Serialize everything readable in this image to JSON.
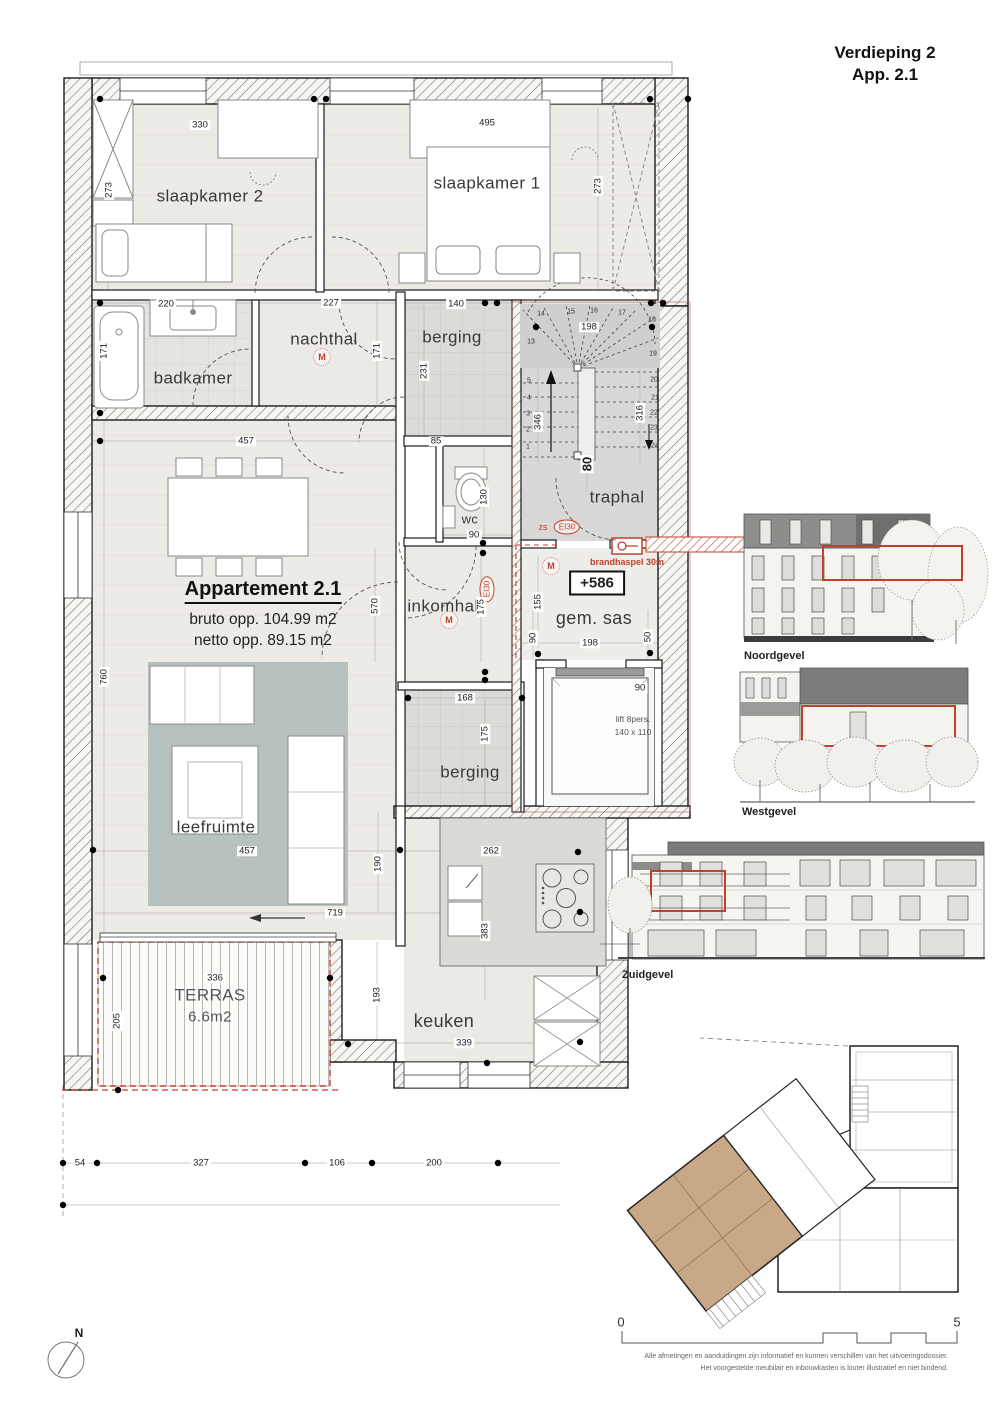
{
  "title": {
    "line1": "Verdieping 2",
    "line2": "App. 2.1"
  },
  "apartment": {
    "name": "Appartement 2.1",
    "bruto": "bruto opp. 104.99 m2",
    "netto": "netto opp. 89.15 m2"
  },
  "rooms": {
    "slaapkamer2": "slaapkamer 2",
    "slaapkamer1": "slaapkamer 1",
    "badkamer": "badkamer",
    "nachthal": "nachthal",
    "berging_top": "berging",
    "traphal": "traphal",
    "wc": "wc",
    "inkomhal": "inkomhal",
    "gem_sas": "gem. sas",
    "berging_bottom": "berging",
    "leefruimte": "leefruimte",
    "keuken": "keuken",
    "terras": "TERRAS",
    "terras_area": "6.6m2"
  },
  "annotations": {
    "level": "+586",
    "brandhaspel": "brandhaspel 30m",
    "zs": "zs",
    "ei30": "EI30",
    "lift_line1": "lift 8pers.",
    "lift_line2": "140 x 110",
    "m": "M"
  },
  "dims": [
    "330",
    "495",
    "273",
    "273",
    "220",
    "227",
    "140",
    "171",
    "171",
    "198",
    "231",
    "85",
    "346",
    "316",
    "80",
    "130",
    "90",
    "457",
    "570",
    "175",
    "155",
    "90",
    "198",
    "50",
    "760",
    "457",
    "719",
    "190",
    "168",
    "175",
    "90",
    "262",
    "383",
    "193",
    "339",
    "336",
    "205",
    "54",
    "327",
    "106",
    "200"
  ],
  "stairs": {
    "numbers": [
      "1",
      "2",
      "3",
      "4",
      "5",
      "13",
      "14",
      "15",
      "16",
      "17",
      "18",
      "19",
      "20",
      "21",
      "22",
      "23",
      "24"
    ]
  },
  "elevations": {
    "noord": "Noordgevel",
    "west": "Westgevel",
    "zuid": "Zuidgevel"
  },
  "scalebar": {
    "start": "0",
    "end": "5"
  },
  "compass": {
    "label": "N"
  },
  "disclaimer": {
    "line1": "Alle afmetingen en aanduidingen zijn informatief en kunnen verschillen van het uitvoeringsdossier.",
    "line2": "Het voorgestelde meubilair en inbouwkasten is louter illustratief en niet bindend."
  },
  "colors": {
    "accent_red": "#c2402a",
    "unit_highlight": "#c9a887",
    "rug": "#b7c1bf"
  }
}
